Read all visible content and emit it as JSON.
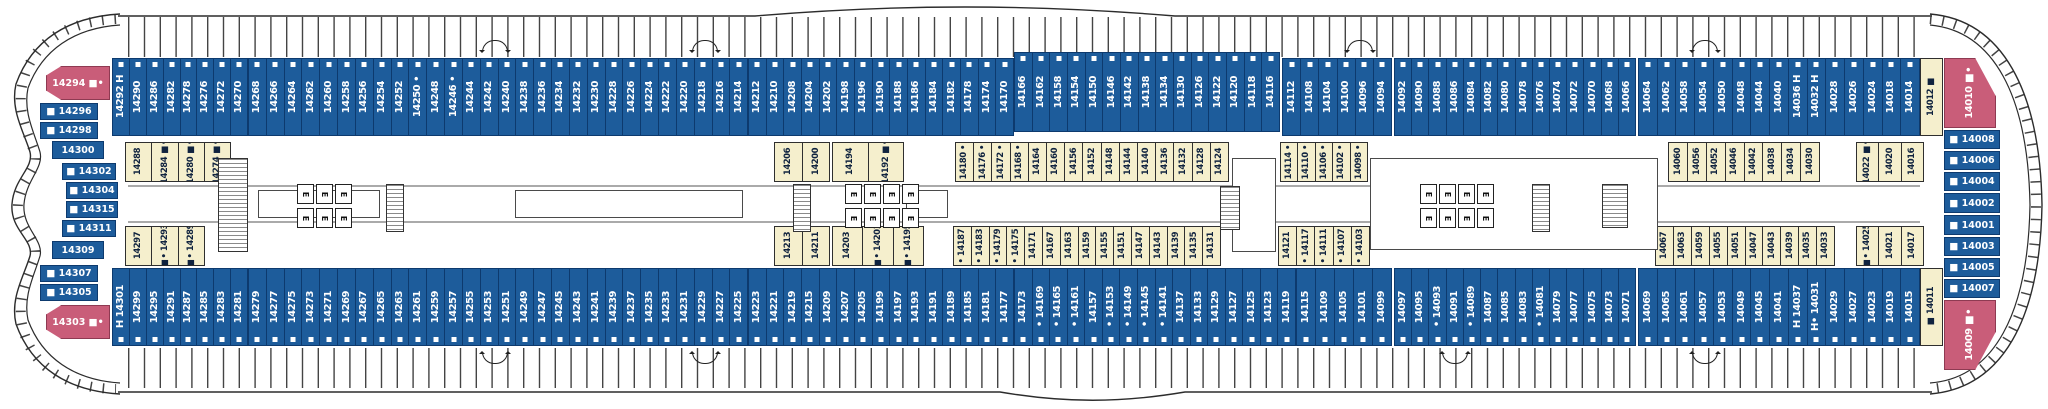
{
  "plan_name": "cruise-ship-deck-plan-deck-14",
  "colors": {
    "balcony_cabin_blue": "#1d5c9b",
    "inside_cabin_yellow": "#f5efcd",
    "suite_pink": "#c95d79",
    "outline": "#0d3a6e"
  },
  "elevator_label": "E",
  "strips": [
    {
      "id": "top-outer-1",
      "x": 112,
      "y": 58,
      "w": 136,
      "h": 78,
      "style": "blue",
      "dir": "top",
      "cls": "outer",
      "cabins": [
        "14292|H",
        "14290",
        "14286",
        "14282",
        "14278",
        "14276",
        "14272",
        "14270"
      ]
    },
    {
      "id": "top-outer-2",
      "x": 248,
      "y": 58,
      "w": 500,
      "h": 78,
      "style": "blue",
      "dir": "top",
      "cls": "outer",
      "cabins": [
        "14268",
        "14266",
        "14264",
        "14262",
        "14260",
        "14258",
        "14256",
        "14254",
        "14252",
        "14250|•",
        "14248",
        "14246|•",
        "14244",
        "14242",
        "14240",
        "14238",
        "14236",
        "14234",
        "14232",
        "14230",
        "14228",
        "14226",
        "14224",
        "14222",
        "14220",
        "14218",
        "14216",
        "14214"
      ]
    },
    {
      "id": "top-outer-3",
      "x": 748,
      "y": 58,
      "w": 266,
      "h": 78,
      "style": "blue",
      "dir": "top",
      "cls": "outer",
      "cabins": [
        "14212",
        "14210",
        "14208",
        "14204",
        "14202",
        "14198",
        "14196",
        "14190",
        "14188",
        "14186",
        "14184",
        "14182",
        "14178",
        "14174",
        "14170"
      ]
    },
    {
      "id": "top-outer-4",
      "x": 1014,
      "y": 52,
      "w": 266,
      "h": 80,
      "style": "blue",
      "dir": "top",
      "cls": "outer",
      "cabins": [
        "14166",
        "14162",
        "14158",
        "14154",
        "14150",
        "14146",
        "14142",
        "14138",
        "14134",
        "14130",
        "14126",
        "14122",
        "14120",
        "14118",
        "14116"
      ]
    },
    {
      "id": "top-outer-5",
      "x": 1282,
      "y": 58,
      "w": 110,
      "h": 78,
      "style": "blue",
      "dir": "top",
      "cls": "outer",
      "cabins": [
        "14112",
        "14108",
        "14104",
        "14100",
        "14096",
        "14094"
      ]
    },
    {
      "id": "top-outer-6",
      "x": 1394,
      "y": 58,
      "w": 242,
      "h": 78,
      "style": "blue",
      "dir": "top",
      "cls": "outer",
      "cabins": [
        "14092",
        "14090",
        "14088",
        "14086",
        "14084",
        "14082",
        "14080",
        "14078",
        "14076",
        "14074",
        "14072",
        "14070",
        "14068",
        "14066"
      ]
    },
    {
      "id": "top-outer-7",
      "x": 1638,
      "y": 58,
      "w": 282,
      "h": 78,
      "style": "blue",
      "dir": "top",
      "cls": "outer",
      "cabins": [
        "14064",
        "14062",
        "14058",
        "14054",
        "14050",
        "14048",
        "14044",
        "14040",
        "14036|H",
        "14032|H",
        "14028",
        "14026",
        "14024",
        "14018",
        "14014"
      ]
    },
    {
      "id": "top-outer-bow",
      "x": 1920,
      "y": 58,
      "w": 23,
      "h": 78,
      "style": "yellow",
      "dir": "top",
      "cls": "outer",
      "cabins": [
        "14012|■"
      ]
    },
    {
      "id": "top-inner-1",
      "x": 125,
      "y": 142,
      "w": 106,
      "h": 40,
      "style": "yellow",
      "dir": "top",
      "cls": "inner",
      "cabins": [
        "14288",
        "14284|■•",
        "14280|■•",
        "14274|■•"
      ]
    },
    {
      "id": "top-inner-2",
      "x": 774,
      "y": 142,
      "w": 56,
      "h": 40,
      "style": "yellow",
      "dir": "top",
      "cls": "inner",
      "cabins": [
        "14206",
        "14200"
      ]
    },
    {
      "id": "top-inner-3",
      "x": 832,
      "y": 142,
      "w": 72,
      "h": 40,
      "style": "yellow",
      "dir": "top",
      "cls": "inner",
      "cabins": [
        "14194",
        "14192|■•"
      ]
    },
    {
      "id": "top-inner-4",
      "x": 955,
      "y": 142,
      "w": 274,
      "h": 40,
      "style": "yellow",
      "dir": "top",
      "cls": "inner",
      "cabins": [
        "14180|•",
        "14176|•",
        "14172|•",
        "14168|•",
        "14164",
        "14160",
        "14156",
        "14152",
        "14148",
        "14144",
        "14140",
        "14136",
        "14132",
        "14128",
        "14124"
      ]
    },
    {
      "id": "top-inner-5",
      "x": 1280,
      "y": 142,
      "w": 88,
      "h": 40,
      "style": "yellow",
      "dir": "top",
      "cls": "inner",
      "cabins": [
        "14114|•",
        "14110|•",
        "14106|•",
        "14102|•",
        "14098|•"
      ]
    },
    {
      "id": "top-inner-6",
      "x": 1668,
      "y": 142,
      "w": 152,
      "h": 40,
      "style": "yellow",
      "dir": "top",
      "cls": "inner",
      "cabins": [
        "14060",
        "14056",
        "14052",
        "14046",
        "14042",
        "14038",
        "14034",
        "14030"
      ]
    },
    {
      "id": "top-inner-7",
      "x": 1856,
      "y": 142,
      "w": 68,
      "h": 40,
      "style": "yellow",
      "dir": "top",
      "cls": "inner",
      "cabins": [
        "14022|■•",
        "14020",
        "14016"
      ]
    },
    {
      "id": "bottom-inner-1",
      "x": 125,
      "y": 226,
      "w": 80,
      "h": 40,
      "style": "yellow",
      "dir": "bottom",
      "cls": "inner",
      "cabins": [
        "14297",
        "14293|■•",
        "14289|■•"
      ]
    },
    {
      "id": "bottom-inner-2",
      "x": 774,
      "y": 226,
      "w": 56,
      "h": 40,
      "style": "yellow",
      "dir": "bottom",
      "cls": "inner",
      "cabins": [
        "14213",
        "14211"
      ]
    },
    {
      "id": "bottom-inner-3",
      "x": 832,
      "y": 226,
      "w": 92,
      "h": 40,
      "style": "yellow",
      "dir": "bottom",
      "cls": "inner",
      "cabins": [
        "14203",
        "14201|■•",
        "14195|■•"
      ]
    },
    {
      "id": "bottom-inner-4",
      "x": 953,
      "y": 226,
      "w": 268,
      "h": 40,
      "style": "yellow",
      "dir": "bottom",
      "cls": "inner",
      "cabins": [
        "14187|•",
        "14183|•",
        "14179|•",
        "14175|•",
        "14171",
        "14167",
        "14163",
        "14159",
        "14155",
        "14151",
        "14147",
        "14143",
        "14139",
        "14135",
        "14131"
      ]
    },
    {
      "id": "bottom-inner-5",
      "x": 1278,
      "y": 226,
      "w": 92,
      "h": 40,
      "style": "yellow",
      "dir": "bottom",
      "cls": "inner",
      "cabins": [
        "14121",
        "14117|•",
        "14111|•",
        "14107|•",
        "14103|•"
      ]
    },
    {
      "id": "bottom-inner-6",
      "x": 1655,
      "y": 226,
      "w": 180,
      "h": 40,
      "style": "yellow",
      "dir": "bottom",
      "cls": "inner",
      "cabins": [
        "14067",
        "14063",
        "14059",
        "14055",
        "14051",
        "14047",
        "14043",
        "14039",
        "14035",
        "14033"
      ]
    },
    {
      "id": "bottom-inner-7",
      "x": 1856,
      "y": 226,
      "w": 68,
      "h": 40,
      "style": "yellow",
      "dir": "bottom",
      "cls": "inner",
      "cabins": [
        "14025|■•",
        "14021",
        "14017"
      ]
    },
    {
      "id": "bottom-outer-1",
      "x": 112,
      "y": 268,
      "w": 136,
      "h": 78,
      "style": "blue",
      "dir": "bottom",
      "cls": "outer",
      "cabins": [
        "14301|H",
        "14299",
        "14295",
        "14291",
        "14287",
        "14285",
        "14283",
        "14281"
      ]
    },
    {
      "id": "bottom-outer-2",
      "x": 248,
      "y": 268,
      "w": 500,
      "h": 78,
      "style": "blue",
      "dir": "bottom",
      "cls": "outer",
      "cabins": [
        "14279",
        "14277",
        "14275",
        "14273",
        "14271",
        "14269",
        "14267",
        "14265",
        "14263",
        "14261",
        "14259",
        "14257",
        "14255",
        "14253",
        "14251",
        "14249",
        "14247",
        "14245",
        "14243",
        "14241",
        "14239",
        "14237",
        "14235",
        "14233",
        "14231",
        "14229",
        "14227",
        "14225"
      ]
    },
    {
      "id": "bottom-outer-3",
      "x": 748,
      "y": 268,
      "w": 266,
      "h": 78,
      "style": "blue",
      "dir": "bottom",
      "cls": "outer",
      "cabins": [
        "14223",
        "14221",
        "14219",
        "14215",
        "14209",
        "14207",
        "14205",
        "14199",
        "14197",
        "14193",
        "14191",
        "14189",
        "14185",
        "14181",
        "14177"
      ]
    },
    {
      "id": "bottom-outer-4",
      "x": 1014,
      "y": 268,
      "w": 282,
      "h": 78,
      "style": "blue",
      "dir": "bottom",
      "cls": "outer",
      "cabins": [
        "14173",
        "14169|•",
        "14165|•",
        "14161|•",
        "14157",
        "14153|•",
        "14149|•",
        "14145|•",
        "14141|•",
        "14137",
        "14133",
        "14129",
        "14127",
        "14125",
        "14123",
        "14119"
      ]
    },
    {
      "id": "bottom-outer-5",
      "x": 1296,
      "y": 268,
      "w": 96,
      "h": 78,
      "style": "blue",
      "dir": "bottom",
      "cls": "outer",
      "cabins": [
        "14115",
        "14109",
        "14105",
        "14101",
        "14099"
      ]
    },
    {
      "id": "bottom-outer-6",
      "x": 1394,
      "y": 268,
      "w": 242,
      "h": 78,
      "style": "blue",
      "dir": "bottom",
      "cls": "outer",
      "cabins": [
        "14097",
        "14095",
        "14093|•",
        "14091",
        "14089|•",
        "14087",
        "14085",
        "14083",
        "14081|•",
        "14079",
        "14077",
        "14075",
        "14073",
        "14071"
      ]
    },
    {
      "id": "bottom-outer-7",
      "x": 1638,
      "y": 268,
      "w": 282,
      "h": 78,
      "style": "blue",
      "dir": "bottom",
      "cls": "outer",
      "cabins": [
        "14069",
        "14065",
        "14061",
        "14057",
        "14053",
        "14049",
        "14045",
        "14041",
        "14037|H",
        "14031|H•",
        "14029",
        "14027",
        "14023",
        "14019",
        "14015"
      ]
    },
    {
      "id": "bottom-outer-bow",
      "x": 1920,
      "y": 268,
      "w": 23,
      "h": 78,
      "style": "yellow",
      "dir": "bottom",
      "cls": "outer",
      "cabins": [
        "14011|■"
      ]
    }
  ],
  "end_cabins": [
    {
      "label": "14294 ■•",
      "x": 46,
      "y": 66,
      "w": 64,
      "h": 34,
      "cls": "pink",
      "clip": "stern"
    },
    {
      "label": "■ 14296",
      "x": 40,
      "y": 103,
      "w": 58,
      "h": 17,
      "cls": "blue"
    },
    {
      "label": "■ 14298",
      "x": 40,
      "y": 122,
      "w": 58,
      "h": 17,
      "cls": "blue"
    },
    {
      "label": "14300",
      "x": 52,
      "y": 141,
      "w": 52,
      "h": 18,
      "cls": "blue"
    },
    {
      "label": "■ 14302",
      "x": 62,
      "y": 163,
      "w": 54,
      "h": 17,
      "cls": "blue"
    },
    {
      "label": "■ 14304",
      "x": 66,
      "y": 182,
      "w": 52,
      "h": 17,
      "cls": "blue"
    },
    {
      "label": "■ 14315",
      "x": 66,
      "y": 201,
      "w": 52,
      "h": 17,
      "cls": "blue"
    },
    {
      "label": "■ 14311",
      "x": 62,
      "y": 220,
      "w": 54,
      "h": 17,
      "cls": "blue"
    },
    {
      "label": "14309",
      "x": 52,
      "y": 241,
      "w": 52,
      "h": 18,
      "cls": "blue"
    },
    {
      "label": "■ 14307",
      "x": 40,
      "y": 265,
      "w": 58,
      "h": 17,
      "cls": "blue"
    },
    {
      "label": "■ 14305",
      "x": 40,
      "y": 284,
      "w": 58,
      "h": 17,
      "cls": "blue"
    },
    {
      "label": "14303 ■•",
      "x": 46,
      "y": 305,
      "w": 64,
      "h": 34,
      "cls": "pink",
      "clip": "stern"
    },
    {
      "label": "14010 ■•",
      "x": 1944,
      "y": 58,
      "w": 52,
      "h": 70,
      "cls": "pink",
      "clip": "bowtop",
      "vert": true
    },
    {
      "label": "■ 14008",
      "x": 1944,
      "y": 130,
      "w": 56,
      "h": 19,
      "cls": "blue"
    },
    {
      "label": "■ 14006",
      "x": 1944,
      "y": 151,
      "w": 56,
      "h": 19,
      "cls": "blue"
    },
    {
      "label": "■ 14004",
      "x": 1944,
      "y": 172,
      "w": 56,
      "h": 19,
      "cls": "blue"
    },
    {
      "label": "■ 14002",
      "x": 1944,
      "y": 193,
      "w": 56,
      "h": 20,
      "cls": "blue"
    },
    {
      "label": "■ 14001",
      "x": 1944,
      "y": 215,
      "w": 56,
      "h": 20,
      "cls": "blue"
    },
    {
      "label": "■ 14003",
      "x": 1944,
      "y": 237,
      "w": 56,
      "h": 19,
      "cls": "blue"
    },
    {
      "label": "■ 14005",
      "x": 1944,
      "y": 258,
      "w": 56,
      "h": 19,
      "cls": "blue"
    },
    {
      "label": "■ 14007",
      "x": 1944,
      "y": 279,
      "w": 56,
      "h": 19,
      "cls": "blue"
    },
    {
      "label": "14009 ■•",
      "x": 1944,
      "y": 300,
      "w": 52,
      "h": 70,
      "cls": "pink",
      "clip": "bowbottom",
      "vert": true
    }
  ],
  "elevator_banks": [
    {
      "x": 297,
      "y": 184,
      "count": 3
    },
    {
      "x": 297,
      "y": 208,
      "count": 3
    },
    {
      "x": 845,
      "y": 184,
      "count": 4
    },
    {
      "x": 845,
      "y": 208,
      "count": 4
    },
    {
      "x": 1420,
      "y": 184,
      "count": 4
    },
    {
      "x": 1420,
      "y": 208,
      "count": 4
    }
  ],
  "stairs": [
    {
      "x": 218,
      "y": 158,
      "w": 30,
      "h": 94
    },
    {
      "x": 386,
      "y": 184,
      "w": 18,
      "h": 48
    },
    {
      "x": 793,
      "y": 184,
      "w": 18,
      "h": 48
    },
    {
      "x": 1220,
      "y": 186,
      "w": 20,
      "h": 44
    },
    {
      "x": 1532,
      "y": 184,
      "w": 18,
      "h": 48
    },
    {
      "x": 1602,
      "y": 184,
      "w": 26,
      "h": 44
    }
  ],
  "venues": [
    {
      "x": 258,
      "y": 190,
      "w": 122,
      "h": 28
    },
    {
      "x": 515,
      "y": 190,
      "w": 228,
      "h": 28
    },
    {
      "x": 906,
      "y": 190,
      "w": 42,
      "h": 28
    },
    {
      "x": 1232,
      "y": 158,
      "w": 44,
      "h": 94
    },
    {
      "x": 1370,
      "y": 158,
      "w": 288,
      "h": 92
    }
  ],
  "rotation_arrows": {
    "top": [
      495,
      705,
      1360,
      1705
    ],
    "bottom": [
      495,
      705,
      1455,
      1705
    ]
  }
}
